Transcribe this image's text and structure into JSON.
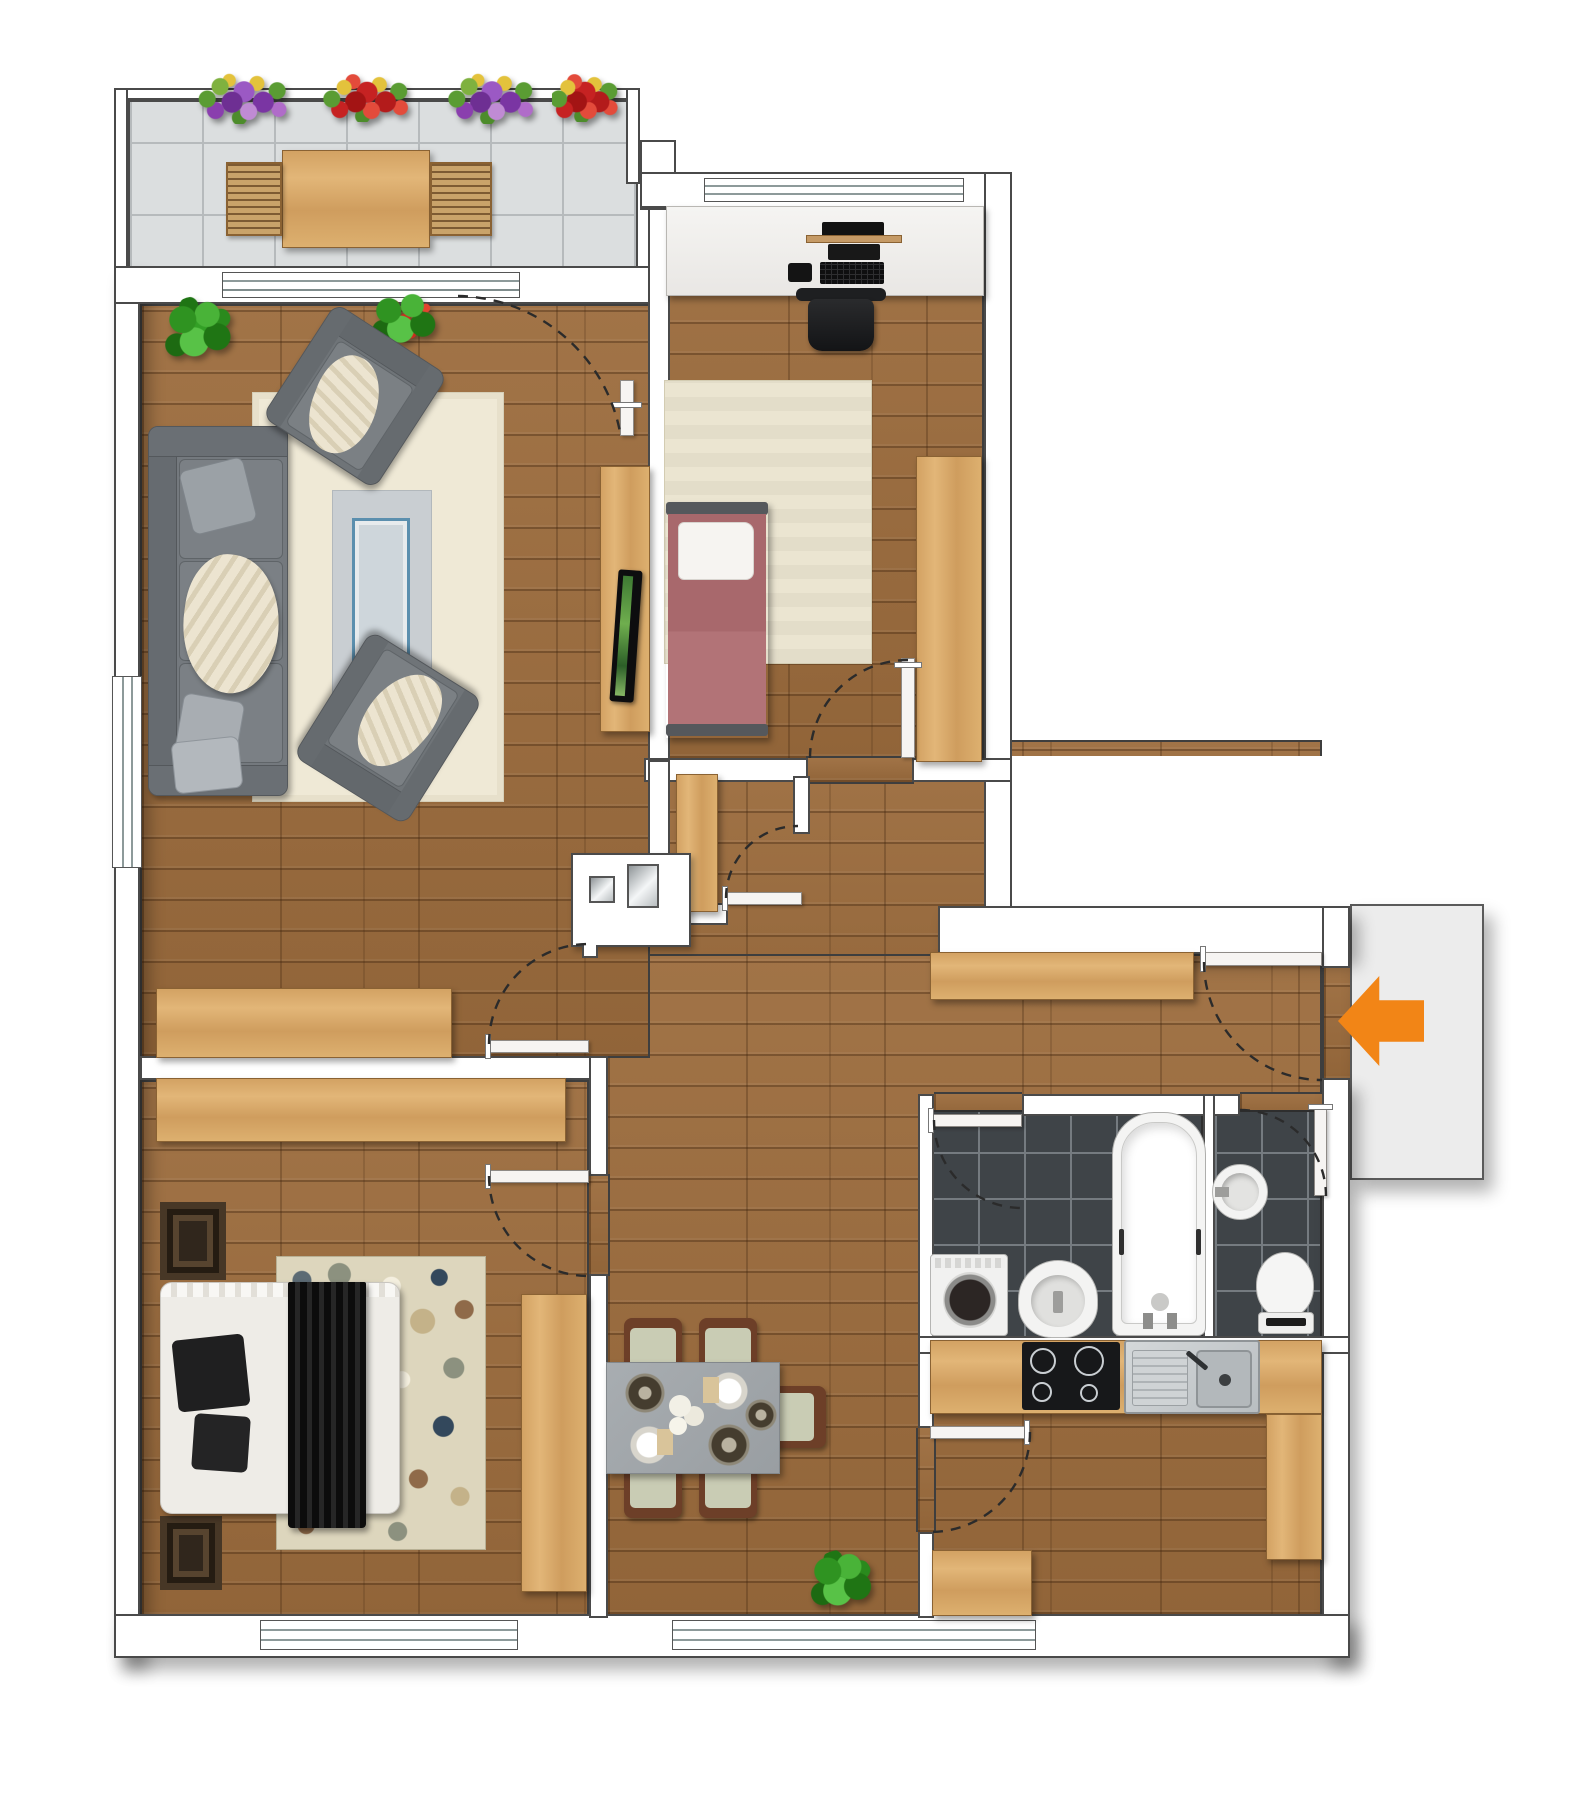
{
  "plan": {
    "type": "apartment-floor-plan",
    "entrance": {
      "marker": "arrow-icon",
      "direction": "left",
      "color": "#F28516"
    },
    "colors": {
      "wall": "#FFFFFF",
      "wall_outline": "#4A4A4A",
      "wood_floor": "#9C6C3D",
      "furniture_wood": "#D9AB6D",
      "balcony_tile": "#DBDEDF",
      "bath_tile": "#3F4448",
      "sofa_gray": "#70757A",
      "rug_cream": "#EFE9D6",
      "rug_inner_gray": "#C9CED2",
      "coffee_table_blue": "#5B8FAE",
      "bed1_mauve": "#A8686C",
      "bed2_blanket": "#141414",
      "dining_table_gray": "#A2A7AB",
      "chair_seat_sage": "#C9CCB4",
      "chair_frame_brown": "#6D3F28",
      "landing_gray": "#ECECEC",
      "door_arc": "#2B2B2B"
    },
    "rooms": [
      {
        "id": "balcony",
        "floor": "tile",
        "furniture": [
          "flower-box-purple",
          "flower-box-red",
          "flower-box-purple",
          "flower-box-red",
          "outdoor-table",
          "bench",
          "bench"
        ]
      },
      {
        "id": "living-room",
        "floor": "wood",
        "furniture": [
          "potted-plant-green",
          "potted-plant-red",
          "armchair",
          "armchair",
          "sofa",
          "area-rug-cream",
          "inner-rug-gray",
          "coffee-table-blue",
          "tv-console",
          "tv",
          "sideboard",
          "balcony-sliding-door",
          "window"
        ]
      },
      {
        "id": "bedroom-top",
        "floor": "wood",
        "furniture": [
          "desk",
          "monitor",
          "keyboard",
          "mouse",
          "office-chair",
          "rug-cream",
          "single-bed-mauve",
          "pillow",
          "wardrobe",
          "window",
          "door"
        ]
      },
      {
        "id": "hallway",
        "floor": "wood",
        "furniture": [
          "built-in-closet",
          "hall-wardrobe",
          "hall-sideboard",
          "corridor-wardrobe",
          "door"
        ]
      },
      {
        "id": "bedroom-bottom",
        "floor": "wood",
        "furniture": [
          "sideboard",
          "nightstand-dark",
          "nightstand-dark",
          "double-bed-black-white",
          "spotted-rug",
          "wardrobe",
          "window",
          "door"
        ]
      },
      {
        "id": "dining-area",
        "floor": "wood",
        "furniture": [
          "dining-table-gray",
          "chair",
          "chair",
          "chair",
          "chair",
          "chair",
          "place-setting-dark",
          "place-setting-white",
          "place-setting-white",
          "place-setting-dark",
          "flower-centerpiece",
          "potted-plant-green",
          "window"
        ]
      },
      {
        "id": "kitchen",
        "floor": "wood",
        "furniture": [
          "counter",
          "cooktop-4-burner",
          "double-sink-steel",
          "base-cabinet",
          "tall-cabinet",
          "door"
        ]
      },
      {
        "id": "bathroom",
        "floor": "dark-tile",
        "furniture": [
          "washing-machine",
          "bidet",
          "bathtub",
          "door"
        ]
      },
      {
        "id": "wc",
        "floor": "dark-tile",
        "furniture": [
          "round-washbasin",
          "toilet",
          "door"
        ]
      },
      {
        "id": "entrance-landing",
        "floor": "gray",
        "furniture": [
          "entrance-door",
          "entrance-arrow"
        ]
      }
    ]
  }
}
